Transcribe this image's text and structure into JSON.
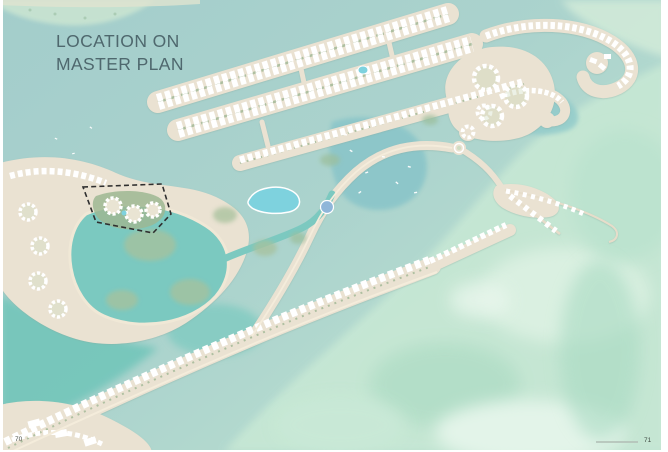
{
  "page": {
    "title_line1": "LOCATION ON",
    "title_line2": "MASTER PLAN",
    "page_number_left": "70",
    "page_number_right": "71"
  },
  "colors": {
    "sea": "#a3cdcb",
    "shallow_water": "#c6e7d4",
    "lagoon": "#70c5b9",
    "lake": "#7bc9c0",
    "marina_water": "#8cc6c9",
    "pool": "#7ed2de",
    "land": "#eae2d2",
    "sand_edge": "#f4ecdb",
    "vegetation": "#a7c19c",
    "buildings": "#ffffff",
    "site_outline": "#2f2f2f",
    "title_text": "#4f686e"
  }
}
